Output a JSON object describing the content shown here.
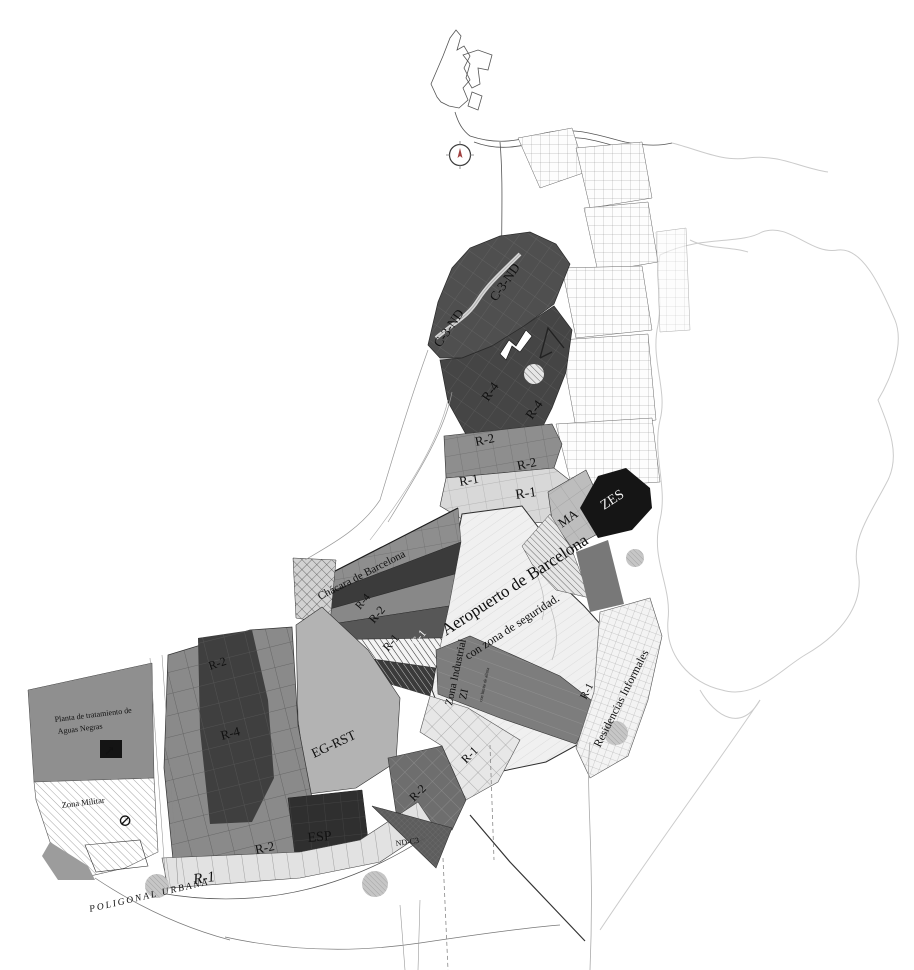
{
  "map": {
    "type": "urban zoning plan (grayscale)",
    "labels": {
      "c3nd_a": "C-3-ND",
      "c3nd_b": "C-3-ND",
      "r4_a": "R-4",
      "r4_b": "R-4",
      "r2_a": "R-2",
      "r2_b": "R-2",
      "r1_a": "R-1",
      "r1_b": "R-1",
      "ma": "MA",
      "zes": "ZES",
      "chacara": "Chácara de Barcelona",
      "fan_r4": "R-4",
      "fan_r2": "R-2",
      "fan_r1": "R-1",
      "fan_c1": "C-1",
      "airport_1": "Aeropuerto de Barcelona",
      "airport_2": "con zona de seguridad.",
      "zi_1": "Zona Industrial",
      "zi_2": "ZI",
      "zi_note": "con límite de altura",
      "residencias": "Residencias Informales",
      "r1_informales": "R-1",
      "grid_r2_a": "R-2",
      "grid_r4": "R-4",
      "eg_rst": "EG-RST",
      "planta_1": "Planta de tratamiento de",
      "planta_2": "Aguas Negras",
      "zona_militar": "Zona Militar",
      "grid_r2_b": "R-2",
      "esp": "ESP",
      "nd_c3": "ND-C3",
      "r2_patch": "R-2",
      "r1_diamond": "R-1",
      "r1_bottom": "R-1",
      "poligonal_urbana": "POLIGONAL URBANA"
    },
    "symbols": {
      "no_entry": "⊘",
      "treatment_arrow": "↗"
    },
    "palette": {
      "zone_dark": "#474747",
      "zone_black": "#151515",
      "zone_medium": "#8c8c8c",
      "zone_light": "#d8d8d8",
      "zone_airport": "#f0f0f0",
      "zone_eg_rst": "#b3b3b3",
      "zone_planta": "#8f8f8f",
      "ink": "#111111",
      "faint_outline": "#cbcbcb",
      "compass_needle": "#a04040"
    }
  }
}
